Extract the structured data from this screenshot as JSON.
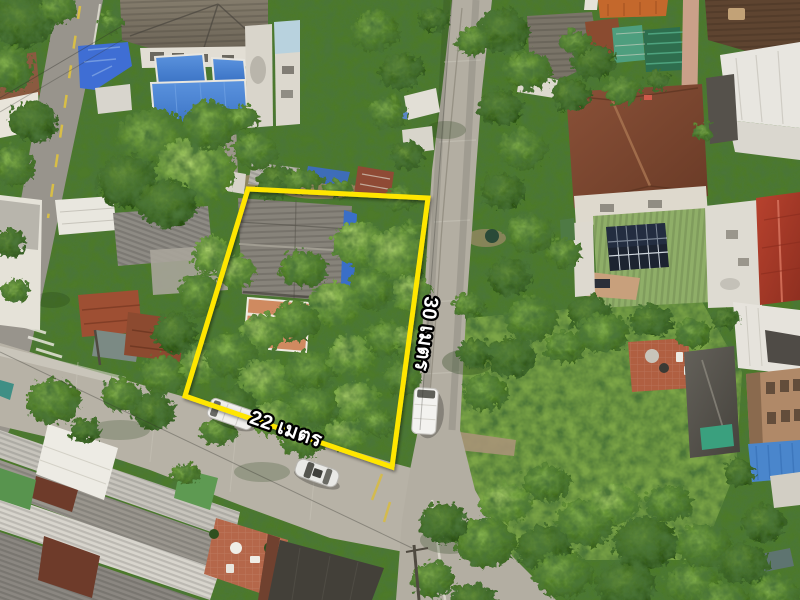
{
  "annotations": {
    "boundary": {
      "color": "#FFE600",
      "shadow_color": "rgba(0,0,0,0.4)"
    },
    "labels": {
      "side_length": "30 เมตร",
      "frontage_width": "22 เมตร",
      "text_color": "#FFFFFF",
      "outline_color": "#000000"
    }
  },
  "palette": {
    "vegetation_base": "#4E7A2C",
    "grass_lot": "#7BA547",
    "concrete_road": "#B7B2A6",
    "asphalt_road": "#98948C",
    "blue_roof_panels": "#4583D6",
    "brown_tile_roof": "#7D4A33",
    "green_solar_roof": "#8FAE68",
    "solar_panel": "#1C2330",
    "red_roof_right": "#B8422E",
    "terracotta_patio": "#B5674A",
    "charcoal_roof": "#57544C",
    "white_roof": "#E8E6E0"
  }
}
